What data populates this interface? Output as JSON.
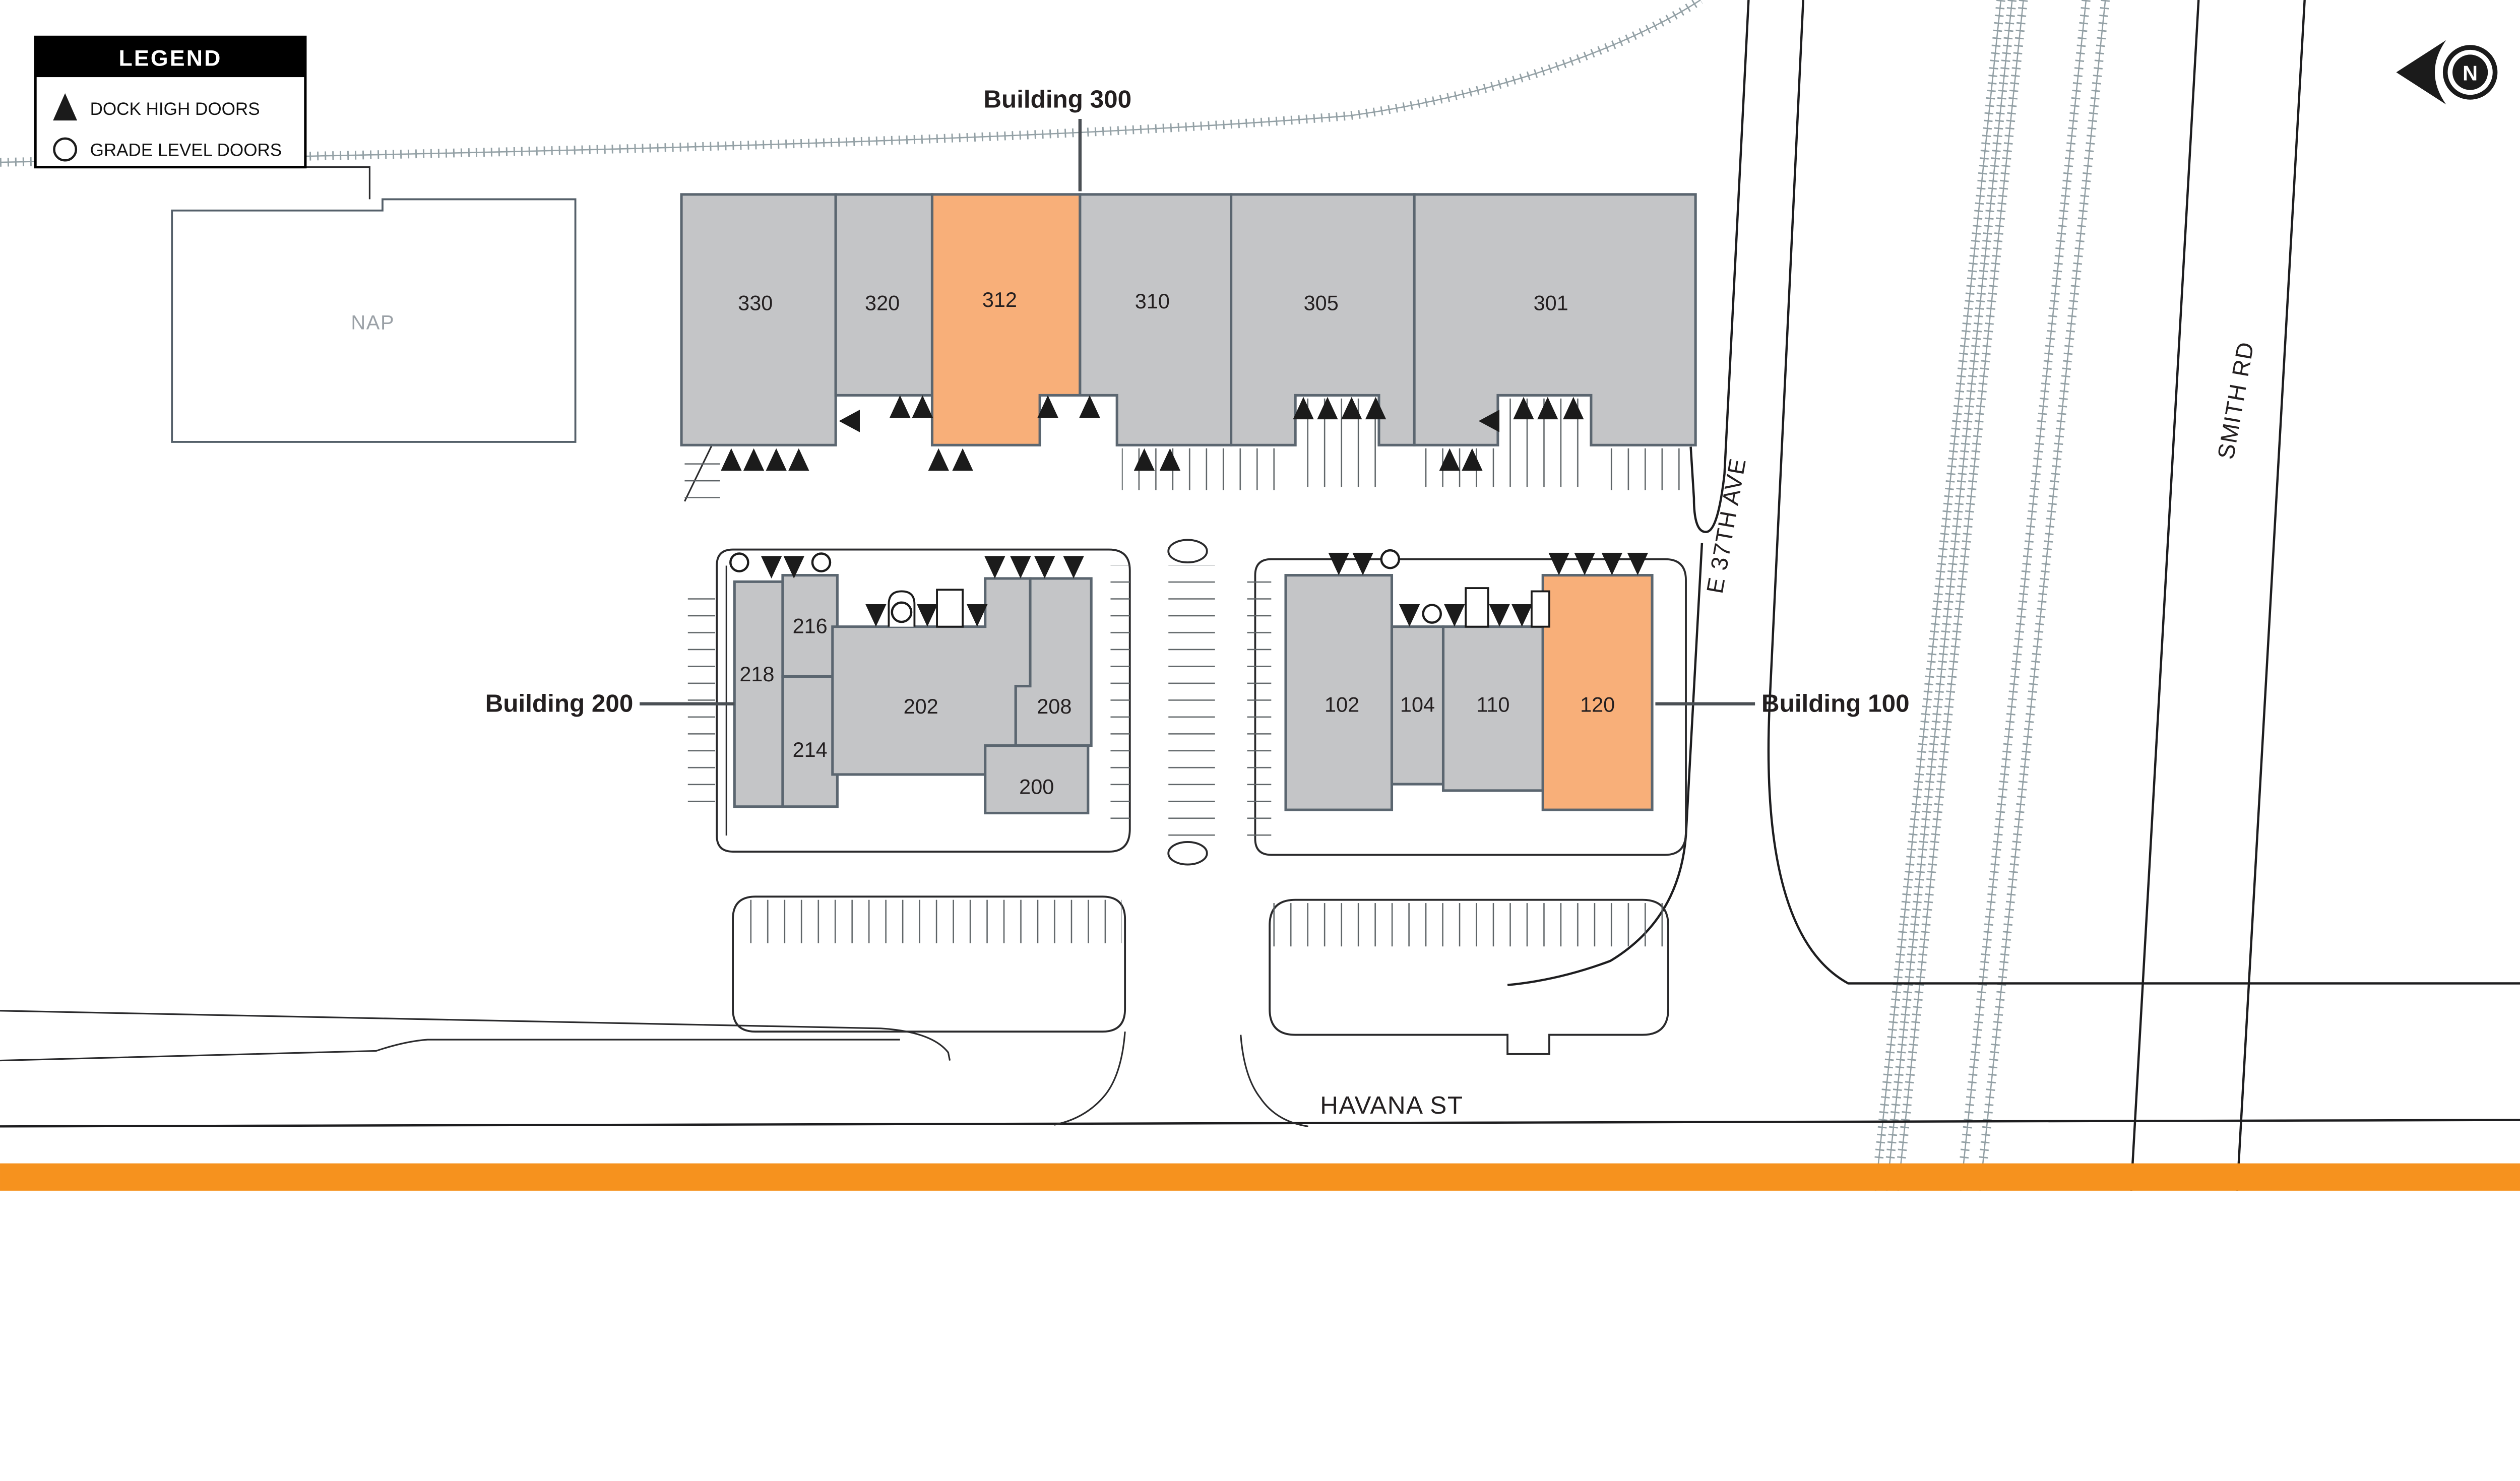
{
  "legend": {
    "title": "LEGEND",
    "items": [
      {
        "icon": "dock-high-door-icon",
        "label": "DOCK HIGH DOORS"
      },
      {
        "icon": "grade-level-door-icon",
        "label": "GRADE LEVEL DOORS"
      }
    ]
  },
  "nap_building": {
    "label": "NAP"
  },
  "buildings": {
    "building_300": {
      "name": "Building 300",
      "units": [
        {
          "id": "330"
        },
        {
          "id": "320"
        },
        {
          "id": "312",
          "highlighted": true
        },
        {
          "id": "310"
        },
        {
          "id": "305"
        },
        {
          "id": "301"
        }
      ]
    },
    "building_200": {
      "name": "Building 200",
      "units": [
        {
          "id": "218"
        },
        {
          "id": "216"
        },
        {
          "id": "214"
        },
        {
          "id": "202"
        },
        {
          "id": "208"
        },
        {
          "id": "200"
        }
      ]
    },
    "building_100": {
      "name": "Building 100",
      "units": [
        {
          "id": "102"
        },
        {
          "id": "104"
        },
        {
          "id": "110"
        },
        {
          "id": "120",
          "highlighted": true
        }
      ]
    }
  },
  "highlighted_units": [
    "312",
    "120"
  ],
  "streets": {
    "e_37th_ave": "E 37TH AVE",
    "smith_rd": "SMITH RD",
    "havana_st": "HAVANA ST"
  },
  "north_arrow": {
    "label": "N"
  },
  "colors": {
    "unit_gray": "#C4C5C7",
    "unit_highlight_orange": "#F8AF79",
    "unit_stroke": "#5B6670",
    "accent_strip_orange": "#F6921E",
    "survey_tick_gray": "#93A0A5"
  }
}
